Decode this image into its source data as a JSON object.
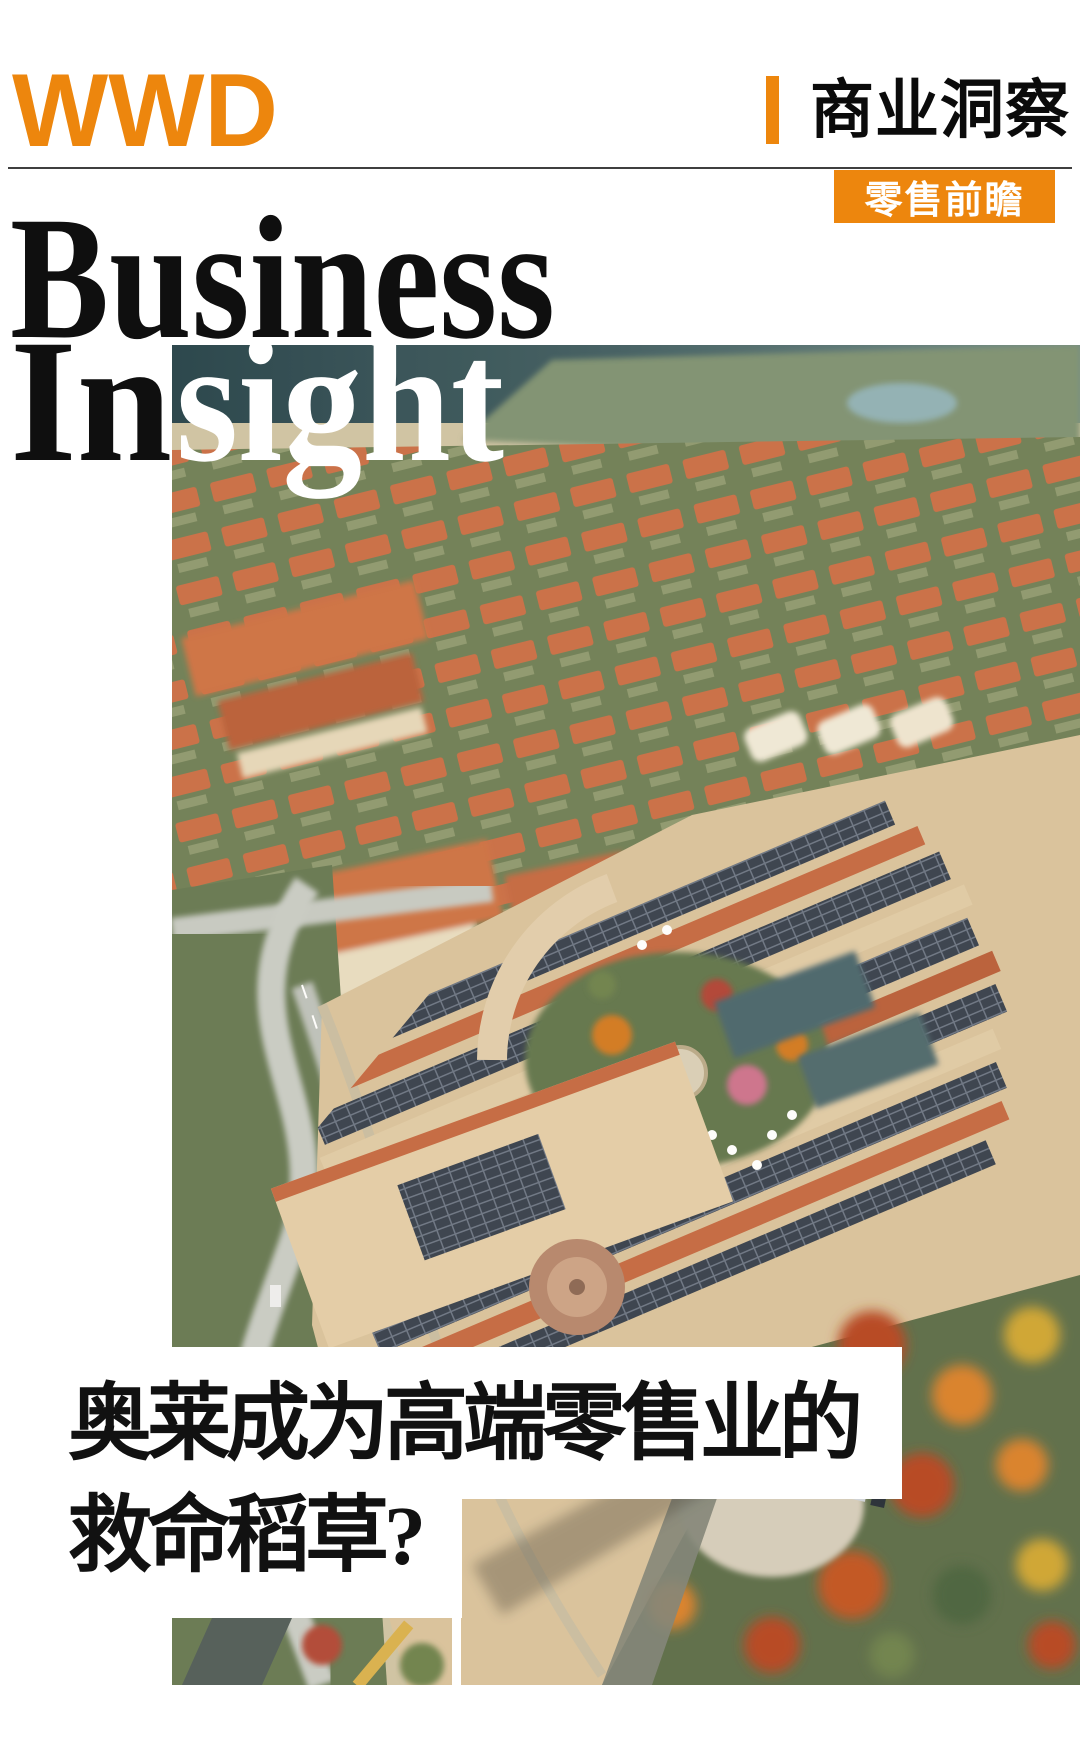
{
  "brand": {
    "name": "WWD",
    "region": "CHINA"
  },
  "header": {
    "section_label": "商业洞察",
    "tag_label": "零售前瞻"
  },
  "masthead": {
    "line1": "Business",
    "line2_black": "In",
    "line2_white": "sight"
  },
  "headline": {
    "line1": "奥莱成为高端零售业的",
    "line2": "救命稻草?"
  },
  "photo": {
    "name": "aerial-outlet-village-photo"
  },
  "colors": {
    "accent_orange": "#ED860D",
    "ink_black": "#111111",
    "tag_text": "#FFFFFF"
  }
}
